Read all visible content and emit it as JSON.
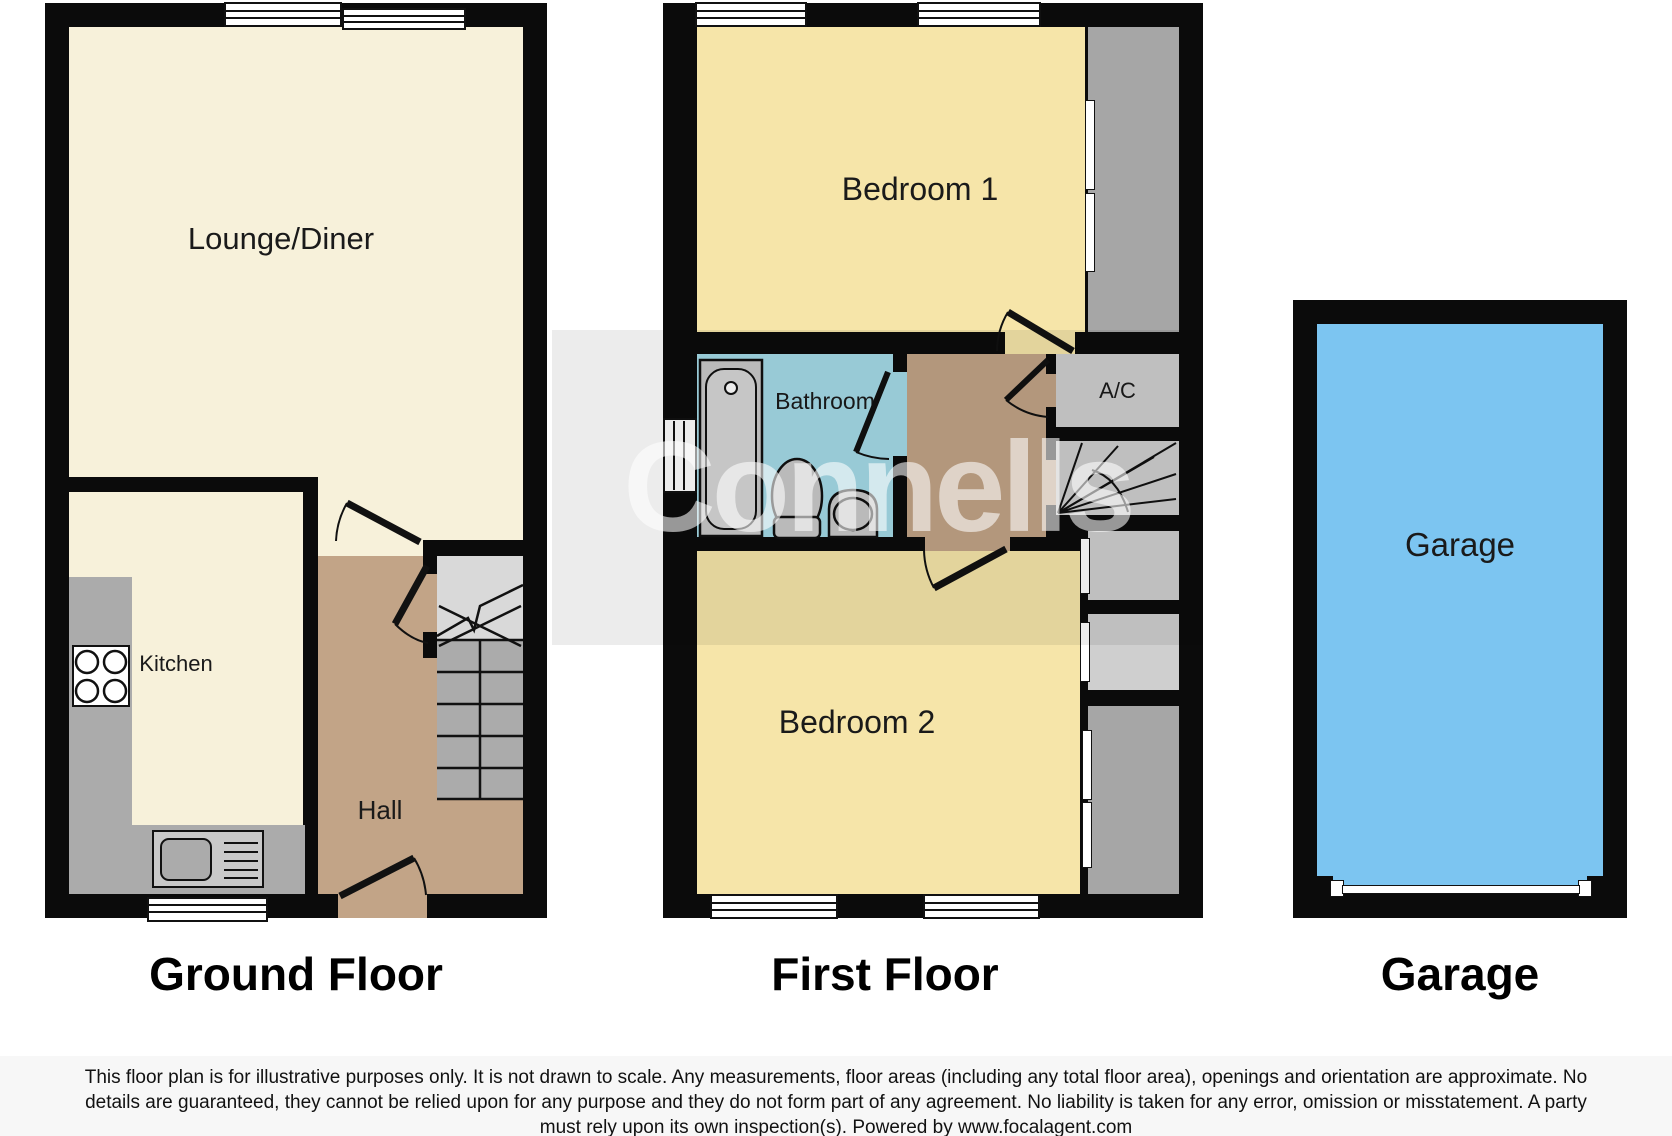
{
  "watermark": {
    "text": "Connells"
  },
  "ground_floor": {
    "title": "Ground Floor",
    "rooms": {
      "lounge": "Lounge/Diner",
      "kitchen": "Kitchen",
      "hall": "Hall"
    }
  },
  "first_floor": {
    "title": "First Floor",
    "rooms": {
      "bedroom1": "Bedroom 1",
      "bathroom": "Bathroom",
      "ac": "A/C",
      "bedroom2": "Bedroom 2"
    }
  },
  "garage": {
    "title": "Garage",
    "rooms": {
      "garage": "Garage"
    }
  },
  "disclaimer": {
    "line1": "This floor plan is for illustrative purposes only. It is not drawn to scale. Any measurements, floor areas (including any total floor area), openings and orientation are approximate. No",
    "line2": "details are guaranteed, they cannot be relied upon for any purpose and they do not form part of any agreement. No liability is taken for any error, omission or misstatement. A party",
    "line3": "must rely upon its own inspection(s). Powered by www.focalagent.com"
  },
  "colors": {
    "wall": "#0b0b0b",
    "lounge_kitchen_cream": "#f7f1da",
    "bedroom_yellow": "#f6e5a9",
    "hall_landing_brown": "#c2a487",
    "bathroom_blue": "#a5dbe8",
    "garage_blue": "#7cc5f1",
    "stairs_counter_gray": "#ababab",
    "closet_gray": "#cfcfcf"
  }
}
